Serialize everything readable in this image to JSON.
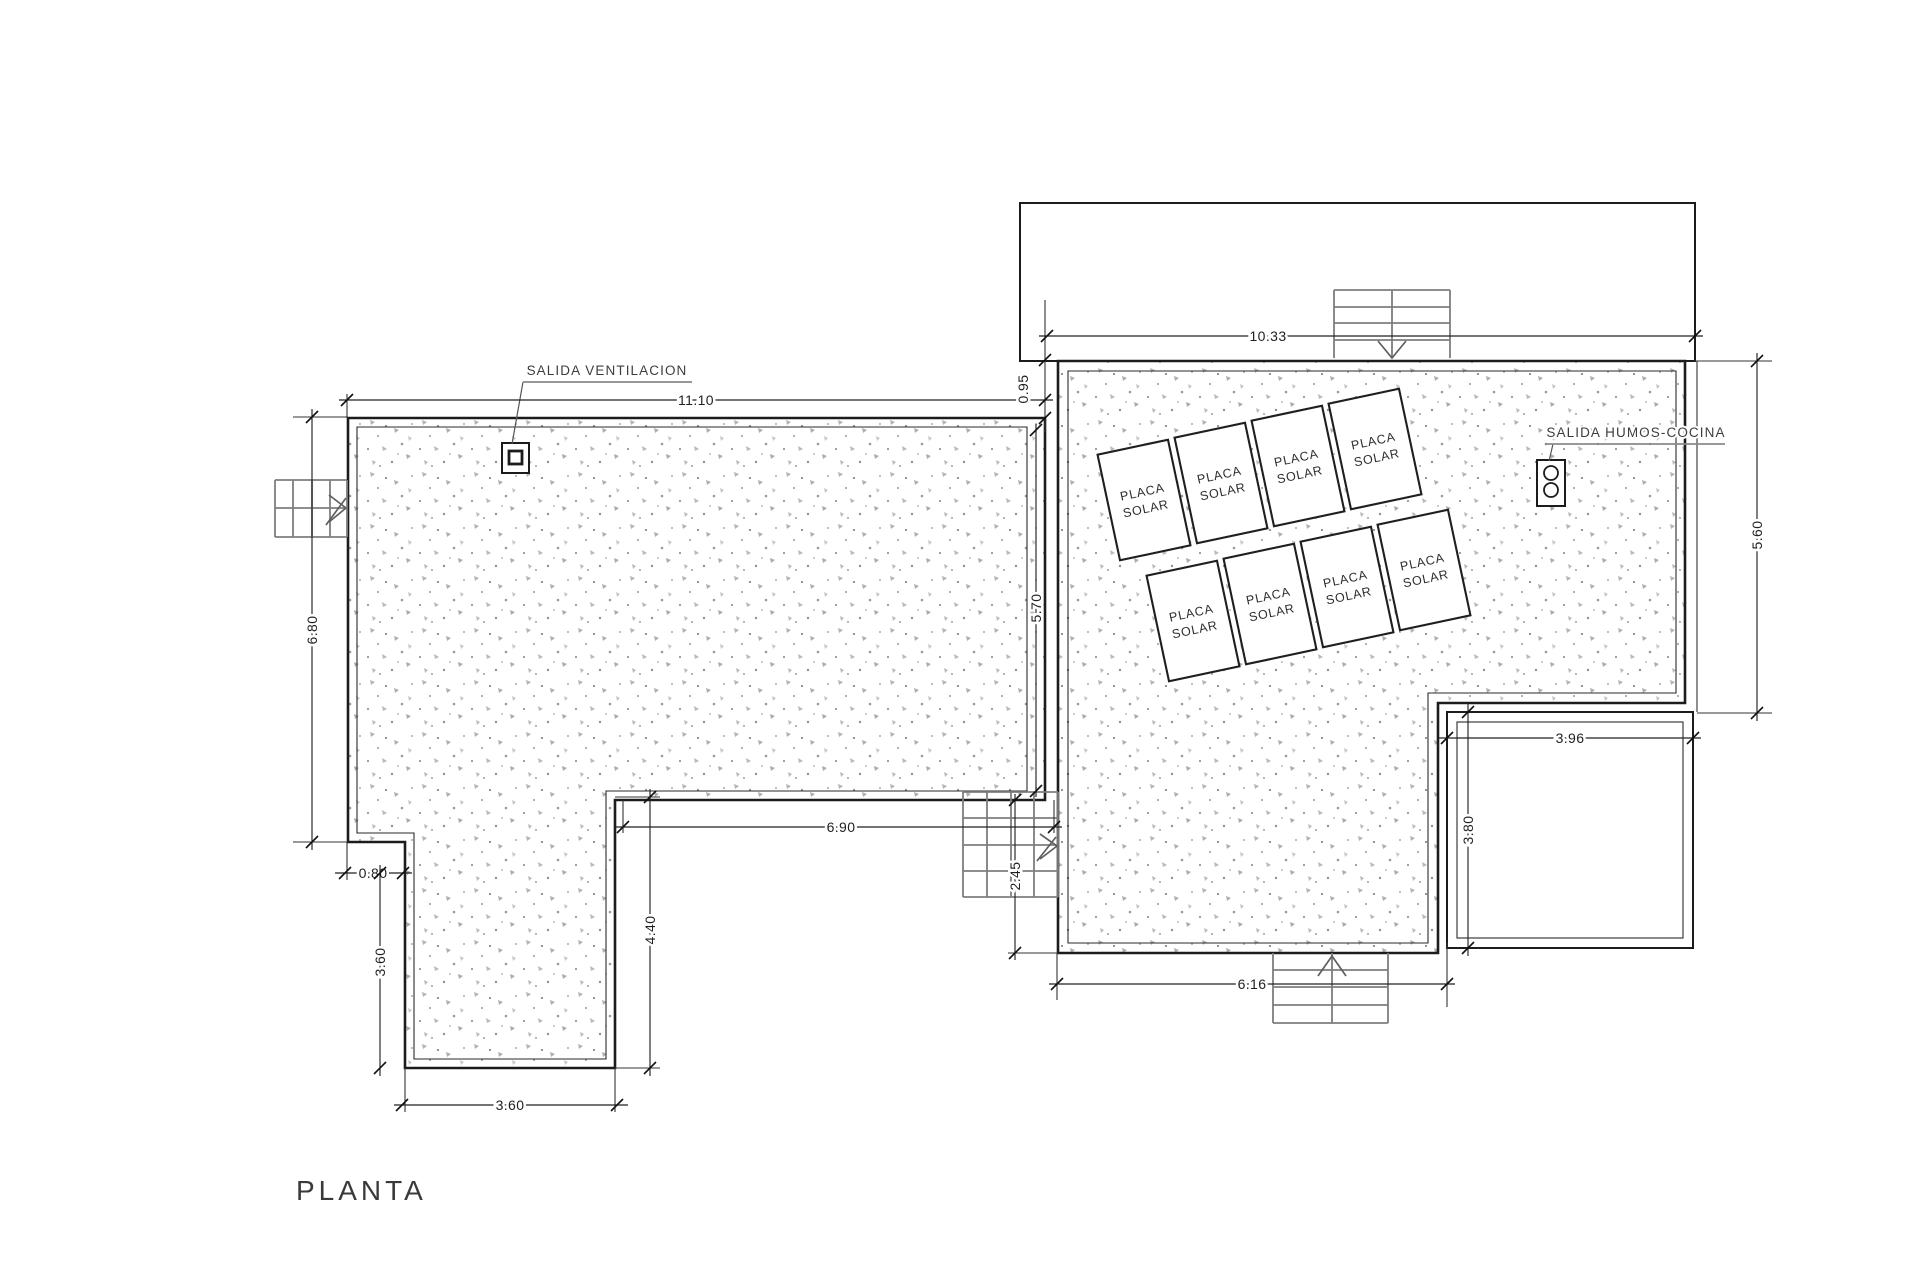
{
  "title": {
    "label": "PLANTA"
  },
  "labels": {
    "vent": "SALIDA VENTILACION",
    "kitchen": "SALIDA HUMOS-COCINA"
  },
  "solar_panel": {
    "line1": "PLACA",
    "line2": "SOLAR",
    "count": 8
  },
  "dimensions": {
    "left_roof_width": "11.10",
    "left_roof_height": "6.80",
    "left_step_offset": "0.80",
    "leg_height": "3.60",
    "leg_width": "3.60",
    "leg_right_height": "4.40",
    "recess_width": "6.90",
    "left_roof_right_height": "5.70",
    "roof_level_offset": "0.95",
    "upper_block_width": "10.33",
    "right_roof_height": "5.60",
    "annex_width": "3.96",
    "annex_height": "3.80",
    "right_roof_bottom_width": "6.16",
    "stair_recess_depth": "2.45"
  }
}
